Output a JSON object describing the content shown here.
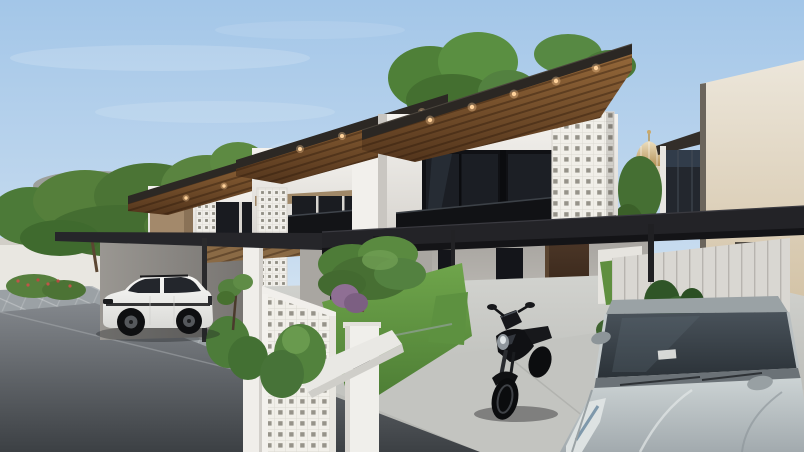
{
  "meta": {
    "alt": "3D exterior rendering of a row of modern minimalist two-storey houses with wooden skillion roofs, breeze-block feature walls, black carport canopies, a white SUV in a carport, a black motorcycle on the driveway and a silver car parked at the right, under a clear blue sky"
  },
  "palette": {
    "sky_top": "#a3c6e8",
    "sky_horizon": "#e8f0f7",
    "roof_wood": "#8f6134",
    "roof_fascia": "#2b2723",
    "wall_white": "#f3f1ed",
    "wall_shadow": "#b5b2ad",
    "accent_tan": "#a3896b",
    "glass_dark": "#1b1e24",
    "canopy_black": "#232327",
    "breeze_block_white": "#f0eee9",
    "downlight_warm": "#ffd29b",
    "lawn_green": "#6aa047",
    "foliage_green": "#4f7f3a",
    "road_asphalt": "#3c4044",
    "paver_grey": "#9ba1a5",
    "concrete": "#c9cac6",
    "suv_white": "#f4f4f2",
    "sedan_silver": "#bcc4c7",
    "motorcycle_black": "#101114",
    "door_timber": "#3a2a1c",
    "dome_gold": "#c9a96b",
    "right_wall_tan": "#cdbb9e"
  },
  "scene": {
    "sky": "clear blue sky with thin white clouds",
    "background_left": "street trees and distant brown-roofed neighbourhood houses behind a white perimeter fence",
    "background_right": "gold mosque dome and a neighbouring dark-glazed two-storey house behind a tall boundary wall",
    "houses": [
      {
        "name": "right-house",
        "storeys": 2,
        "features": [
          "slanted wood-slat roof soffit with warm downlights",
          "dark glazed balcony doors",
          "white breeze-block feature wall",
          "dark timber entry door",
          "narrow dark window",
          "black steel carport canopy",
          "concrete driveway"
        ]
      },
      {
        "name": "middle-house",
        "storeys": 2,
        "features": [
          "wood-slat roof soffit with downlights",
          "dark glazed balcony",
          "breeze-block screen column",
          "white entry porch",
          "front garden with round topiary tree, purple shrub and lawn",
          "gate pillar with black letterbox panel"
        ]
      },
      {
        "name": "left-house",
        "storeys": 2,
        "features": [
          "wood-slat roof soffit",
          "tan accent wall",
          "breeze-block screens",
          "dark balcony glazing",
          "carport sheltering a white SUV"
        ]
      }
    ],
    "vehicles": [
      {
        "name": "white-suv",
        "type": "SUV",
        "color": "white",
        "location": "left carport, facing the street"
      },
      {
        "name": "black-motorcycle",
        "type": "motorcycle",
        "color": "black",
        "location": "centre driveway in front of the right house"
      },
      {
        "name": "silver-car",
        "type": "car",
        "color": "silver",
        "location": "right foreground, nose toward viewer"
      }
    ],
    "street": "dark asphalt road with paver kerb strip, white garden walls with breeze-block infill, green shrubs and concrete driveway aprons"
  }
}
